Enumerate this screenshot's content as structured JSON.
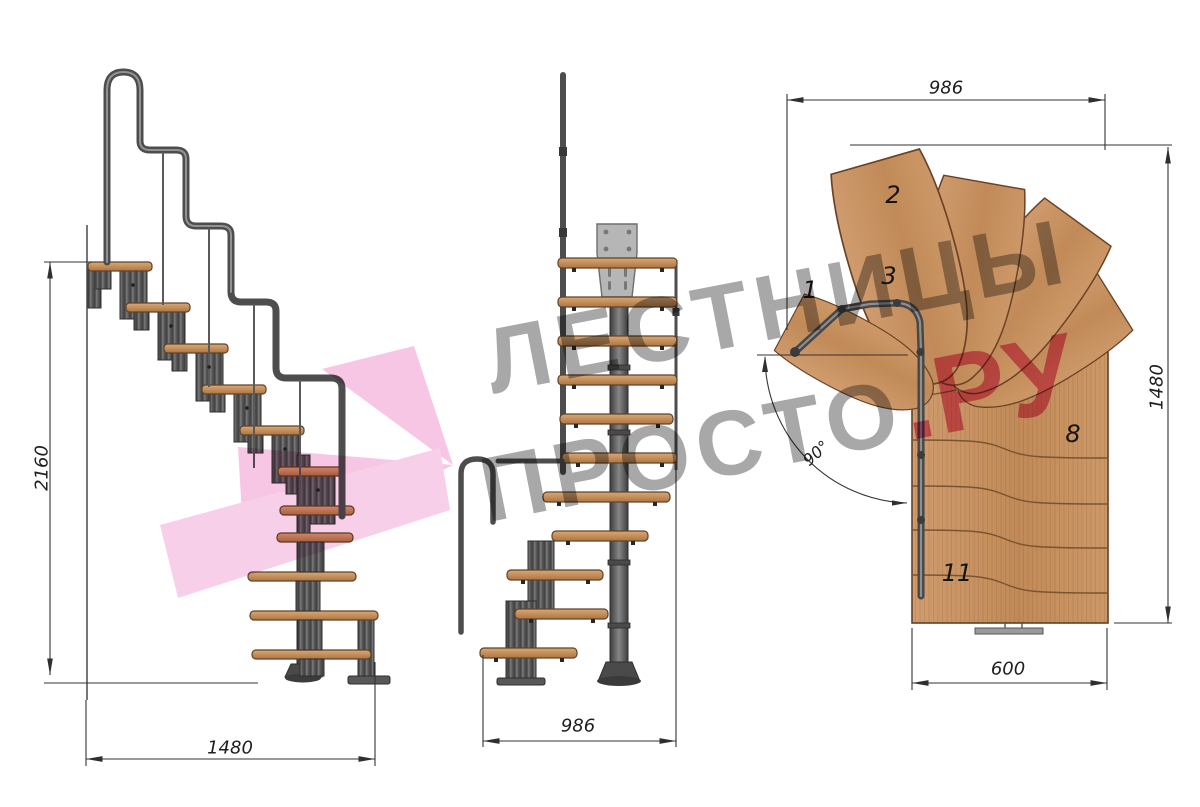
{
  "watermark": {
    "line1": "ЛЕСТНИЦЫ",
    "line2": "ПРОСТО",
    "tld": ".РУ"
  },
  "views": {
    "side": {
      "dim_height": "2160",
      "dim_run": "1480"
    },
    "front": {
      "dim_width": "986"
    },
    "plan": {
      "dim_width": "986",
      "dim_depth": "1480",
      "dim_exit": "600",
      "dim_angle": "90°",
      "step_labels": {
        "s1": "1",
        "s2": "2",
        "s3": "3",
        "s8": "8",
        "s11": "11"
      }
    }
  },
  "colors": {
    "wood": "#c79768",
    "metal": "#4d4d4d",
    "dim_lines": "#333333",
    "watermark_gray": "#8f8f8f",
    "watermark_pink": "#e2538b",
    "arrow_pink": "#f4b9de"
  }
}
